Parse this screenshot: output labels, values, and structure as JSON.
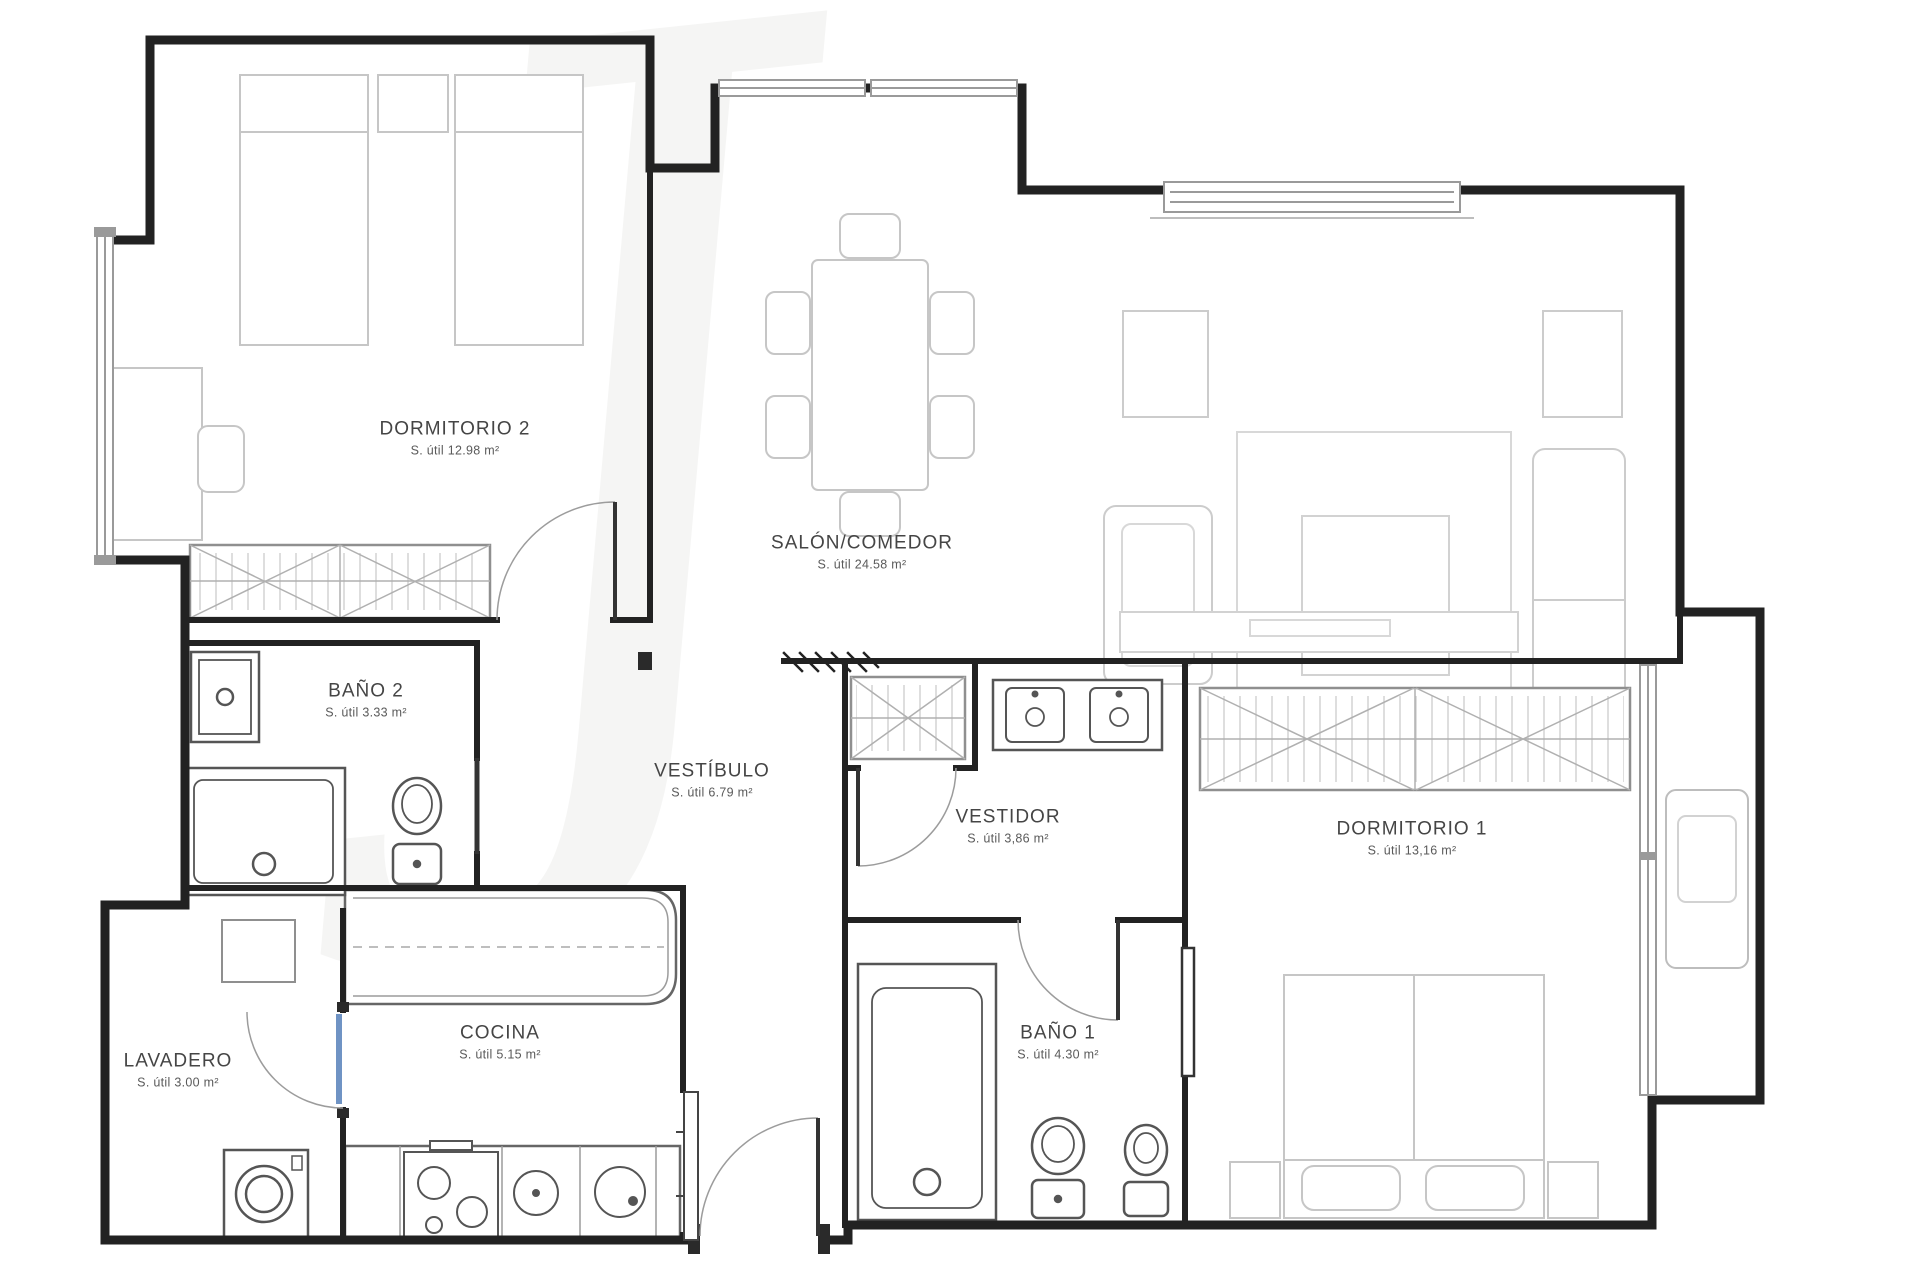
{
  "plan": {
    "type": "apartment-floor-plan",
    "watermark_glyph": "J",
    "accent_door_color": "#6f93c4",
    "wall_color": "#222222"
  },
  "rooms": [
    {
      "id": "dormitorio2",
      "name": "DORMITORIO 2",
      "area": "S. útil 12.98 m²",
      "x": 455,
      "y": 438
    },
    {
      "id": "salon-comedor",
      "name": "SALÓN/COMEDOR",
      "area": "S. útil 24.58 m²",
      "x": 862,
      "y": 552
    },
    {
      "id": "bano2",
      "name": "BAÑO 2",
      "area": "S. útil 3.33 m²",
      "x": 366,
      "y": 700
    },
    {
      "id": "vestibulo",
      "name": "VESTÍBULO",
      "area": "S. útil 6.79 m²",
      "x": 712,
      "y": 780
    },
    {
      "id": "vestidor",
      "name": "VESTIDOR",
      "area": "S. útil 3,86 m²",
      "x": 1008,
      "y": 826
    },
    {
      "id": "dormitorio1",
      "name": "DORMITORIO 1",
      "area": "S. útil 13,16 m²",
      "x": 1412,
      "y": 838
    },
    {
      "id": "lavadero",
      "name": "LAVADERO",
      "area": "S. útil 3.00 m²",
      "x": 178,
      "y": 1070
    },
    {
      "id": "cocina",
      "name": "COCINA",
      "area": "S. útil 5.15 m²",
      "x": 500,
      "y": 1042
    },
    {
      "id": "bano1",
      "name": "BAÑO 1",
      "area": "S. útil 4.30 m²",
      "x": 1058,
      "y": 1042
    }
  ]
}
